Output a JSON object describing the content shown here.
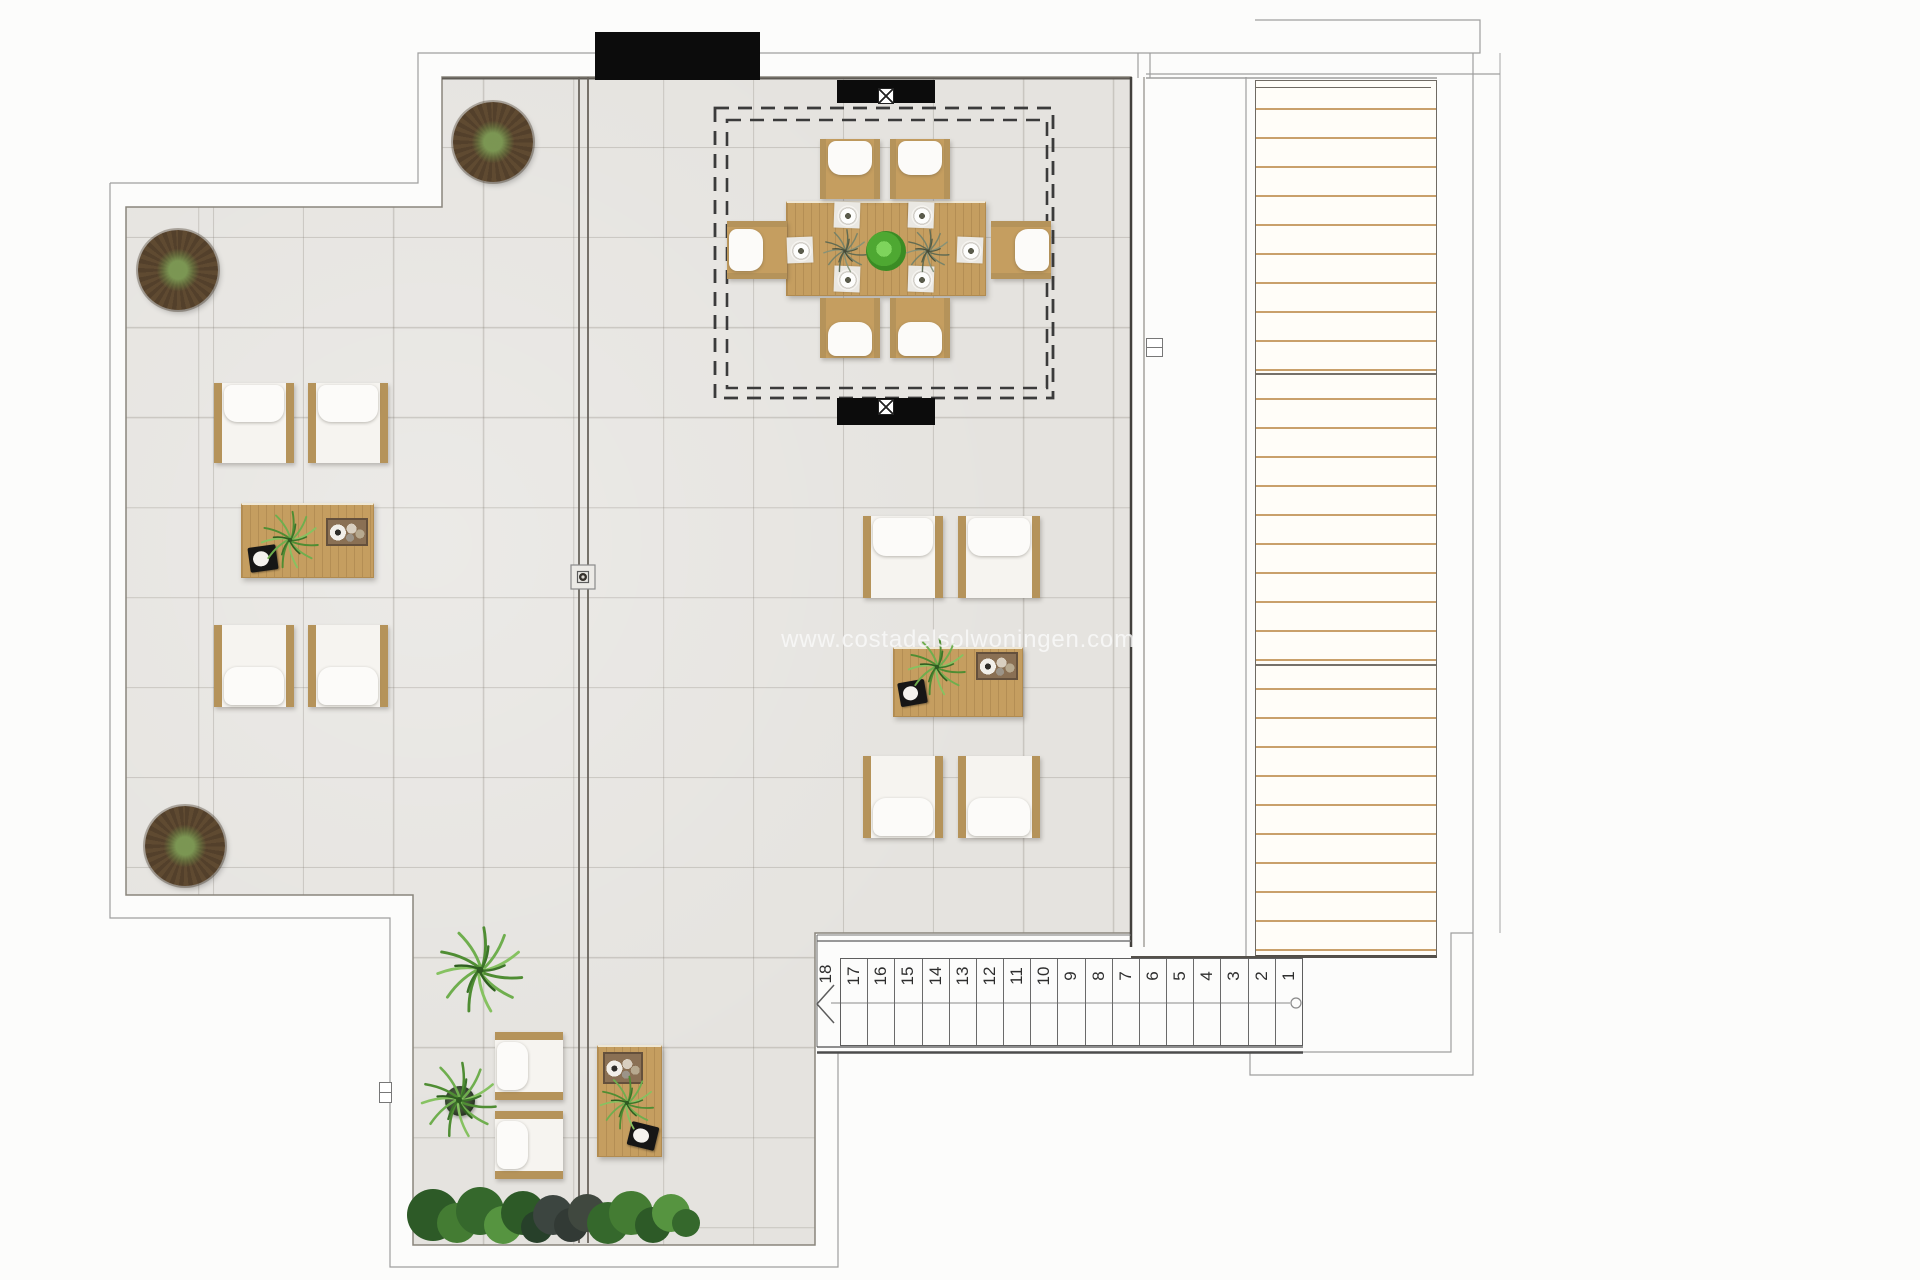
{
  "watermark": {
    "text": "www.costadelsolwoningen.com"
  },
  "stairs": {
    "direction_label": "18",
    "numbers": [
      "17",
      "16",
      "15",
      "14",
      "13",
      "12",
      "11",
      "10",
      "9",
      "8",
      "7",
      "6",
      "5",
      "4",
      "3",
      "2",
      "1"
    ]
  },
  "palette": {
    "paper": "#fcfcfb",
    "floor": "#e5e3df",
    "wood": "#c59e60",
    "wood-frame": "#b5935a",
    "cushion": "#f6f4f0",
    "pillow": "#fcfbf9",
    "slat": "#c9a06b",
    "black": "#0c0c0c",
    "tray-black": "#161616",
    "tray-brown": "#8a7054",
    "tree-brown": "#53402b",
    "plant-green": "#5d9a3c",
    "line-light": "#9e9e9e",
    "line-dark": "#55514b"
  }
}
